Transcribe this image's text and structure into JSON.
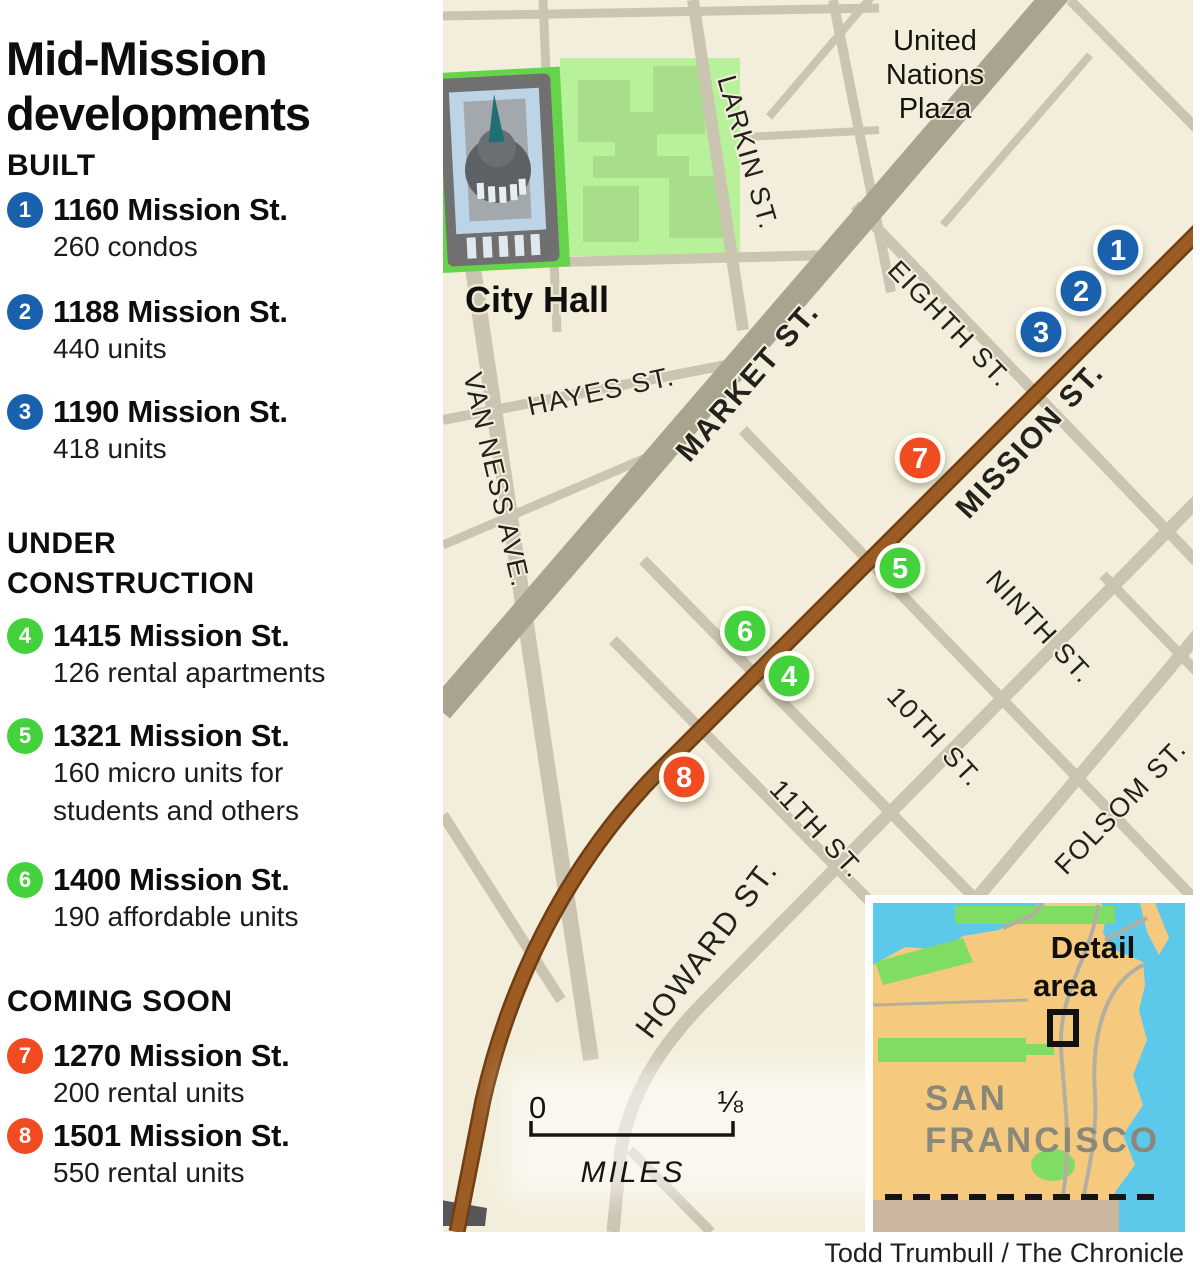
{
  "title_lines": [
    "Mid-Mission",
    "developments"
  ],
  "colors": {
    "built": "#1a61ad",
    "under_construction": "#43d23c",
    "coming_soon": "#f04b21",
    "mission_street_road": "#9c5c24",
    "map_background": "#f3eedb",
    "inset_water": "#5cc8ea",
    "inset_land": "#f6ca7e"
  },
  "legend": {
    "sections": [
      {
        "heading": "BUILT",
        "items": [
          {
            "num": "1",
            "address": "1160 Mission St.",
            "desc": "260 condos"
          },
          {
            "num": "2",
            "address": "1188 Mission St.",
            "desc": "440 units"
          },
          {
            "num": "3",
            "address": "1190 Mission St.",
            "desc": "418 units"
          }
        ]
      },
      {
        "heading": "UNDER CONSTRUCTION",
        "items": [
          {
            "num": "4",
            "address": "1415 Mission St.",
            "desc": "126 rental apartments"
          },
          {
            "num": "5",
            "address": "1321 Mission St.",
            "desc": "160 micro units for students and others"
          },
          {
            "num": "6",
            "address": "1400 Mission St.",
            "desc": "190 affordable units"
          }
        ]
      },
      {
        "heading": "COMING SOON",
        "items": [
          {
            "num": "7",
            "address": "1270 Mission St.",
            "desc": "200 rental units"
          },
          {
            "num": "8",
            "address": "1501 Mission St.",
            "desc": "550 rental units"
          }
        ]
      }
    ]
  },
  "map": {
    "street_labels": {
      "market": "MARKET ST.",
      "mission": "MISSION ST.",
      "larkin": "LARKIN ST.",
      "hayes": "HAYES ST.",
      "van_ness": "VAN NESS AVE.",
      "eighth": "EIGHTH ST.",
      "ninth": "NINTH ST.",
      "tenth": "10TH ST.",
      "eleventh": "11TH ST.",
      "howard": "HOWARD ST.",
      "folsom": "FOLSOM ST."
    },
    "poi": {
      "city_hall": "City Hall",
      "united_nations_plaza": [
        "United",
        "Nations",
        "Plaza"
      ]
    },
    "markers": [
      {
        "label": "1",
        "type": "built"
      },
      {
        "label": "2",
        "type": "built"
      },
      {
        "label": "3",
        "type": "built"
      },
      {
        "label": "4",
        "type": "under_construction"
      },
      {
        "label": "5",
        "type": "under_construction"
      },
      {
        "label": "6",
        "type": "under_construction"
      },
      {
        "label": "7",
        "type": "coming_soon"
      },
      {
        "label": "8",
        "type": "coming_soon"
      }
    ],
    "scale": {
      "start": "0",
      "end": "⅛",
      "unit": "MILES"
    },
    "inset": {
      "detail_area": [
        "Detail",
        "area"
      ],
      "city": [
        "SAN",
        "FRANCISCO"
      ]
    }
  },
  "credit": "Todd Trumbull / The Chronicle"
}
